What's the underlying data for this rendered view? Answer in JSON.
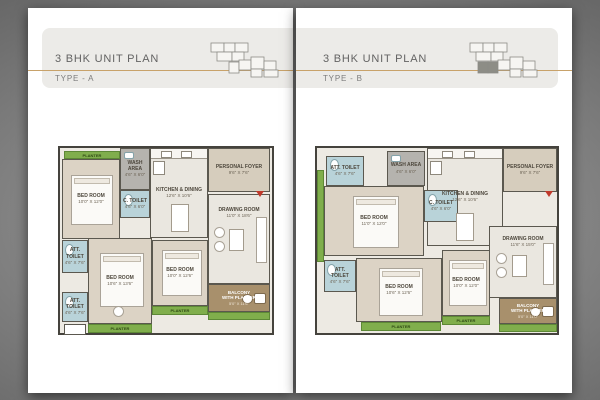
{
  "pages": {
    "a": {
      "title": "3 BHK UNIT PLAN",
      "subtitle": "TYPE - A",
      "planter": "PLANTER",
      "rooms": {
        "bedroom1": {
          "label": "BED ROOM",
          "dims": "10'0\" X 12'0\""
        },
        "wash": {
          "label": "WASH AREA",
          "dims": "4'6\" X 6'0\""
        },
        "ctoilet": {
          "label": "C. TOILET",
          "dims": "4'6\" X 6'0\""
        },
        "kitchen": {
          "label": "KITCHEN & DINING",
          "dims": "12'6\" X 10'6\""
        },
        "foyer": {
          "label": "PERSONAL FOYER",
          "dims": "9'6\" X 7'6\""
        },
        "drawing": {
          "label": "DRAWING ROOM",
          "dims": "11'0\" X 18'6\""
        },
        "atttoilet1": {
          "label": "ATT. TOILET",
          "dims": "4'6\" X 7'6\""
        },
        "bedroom2": {
          "label": "BED ROOM",
          "dims": "10'6\" X 13'6\""
        },
        "atttoilet2": {
          "label": "ATT. TOILET",
          "dims": "4'6\" X 7'6\""
        },
        "bedroom3": {
          "label": "BED ROOM",
          "dims": "10'0\" X 12'6\""
        },
        "balcony": {
          "label": "BALCONY",
          "sub": "WITH PLANTER",
          "dims": "5'0\" X 11'6\""
        }
      }
    },
    "b": {
      "title": "3 BHK UNIT PLAN",
      "subtitle": "TYPE - B",
      "planter": "PLANTER",
      "rooms": {
        "atttoilet1": {
          "label": "ATT. TOILET",
          "dims": "4'6\" X 7'6\""
        },
        "wash": {
          "label": "WASH AREA",
          "dims": "4'6\" X 6'0\""
        },
        "bedroom1": {
          "label": "BED ROOM",
          "dims": "11'0\" X 12'0\""
        },
        "ctoilet": {
          "label": "C. TOILET",
          "dims": "4'6\" X 6'0\""
        },
        "kitchen": {
          "label": "KITCHEN & DINING",
          "dims": "12'6\" X 10'6\""
        },
        "foyer": {
          "label": "PERSONAL FOYER",
          "dims": "9'6\" X 7'6\""
        },
        "drawing": {
          "label": "DRAWING ROOM",
          "dims": "11'6\" X 15'0\""
        },
        "atttoilet2": {
          "label": "ATT. TOILET",
          "dims": "4'6\" X 7'6\""
        },
        "bedroom2": {
          "label": "BED ROOM",
          "dims": "10'6\" X 12'6\""
        },
        "bedroom3": {
          "label": "BED ROOM",
          "dims": "10'0\" X 12'0\""
        },
        "balcony": {
          "label": "BALCONY",
          "sub": "WITH PLANTER",
          "dims": "5'0\" X 11'0\""
        }
      }
    }
  }
}
